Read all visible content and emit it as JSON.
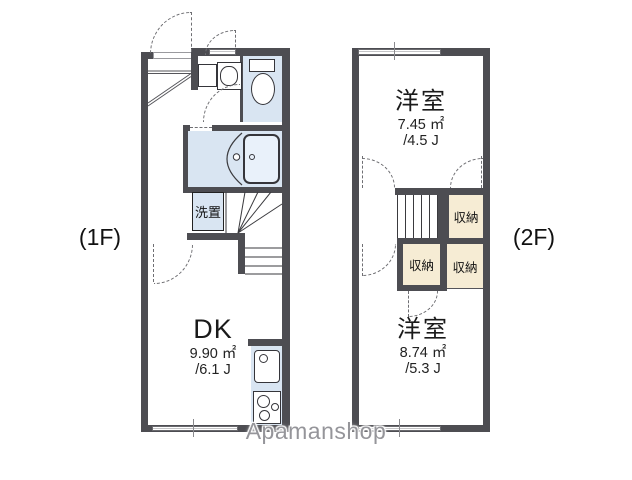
{
  "floor1": {
    "label": "(1F)",
    "dk": {
      "name": "DK",
      "area_m2": "9.90 ㎡",
      "area_tatami": "/6.1 J"
    },
    "washer_label": "洗置"
  },
  "floor2": {
    "label": "(2F)",
    "room_top": {
      "name": "洋室",
      "area_m2": "7.45 ㎡",
      "area_tatami": "/4.5 J"
    },
    "room_bottom": {
      "name": "洋室",
      "area_m2": "8.74 ㎡",
      "area_tatami": "/5.3 J"
    },
    "closets": [
      "収納",
      "収納",
      "収納"
    ]
  },
  "watermark": "Apamanshop",
  "colors": {
    "wall": "#4d4d52",
    "water": "#d9e5f2",
    "closet": "#f6ecd4"
  }
}
